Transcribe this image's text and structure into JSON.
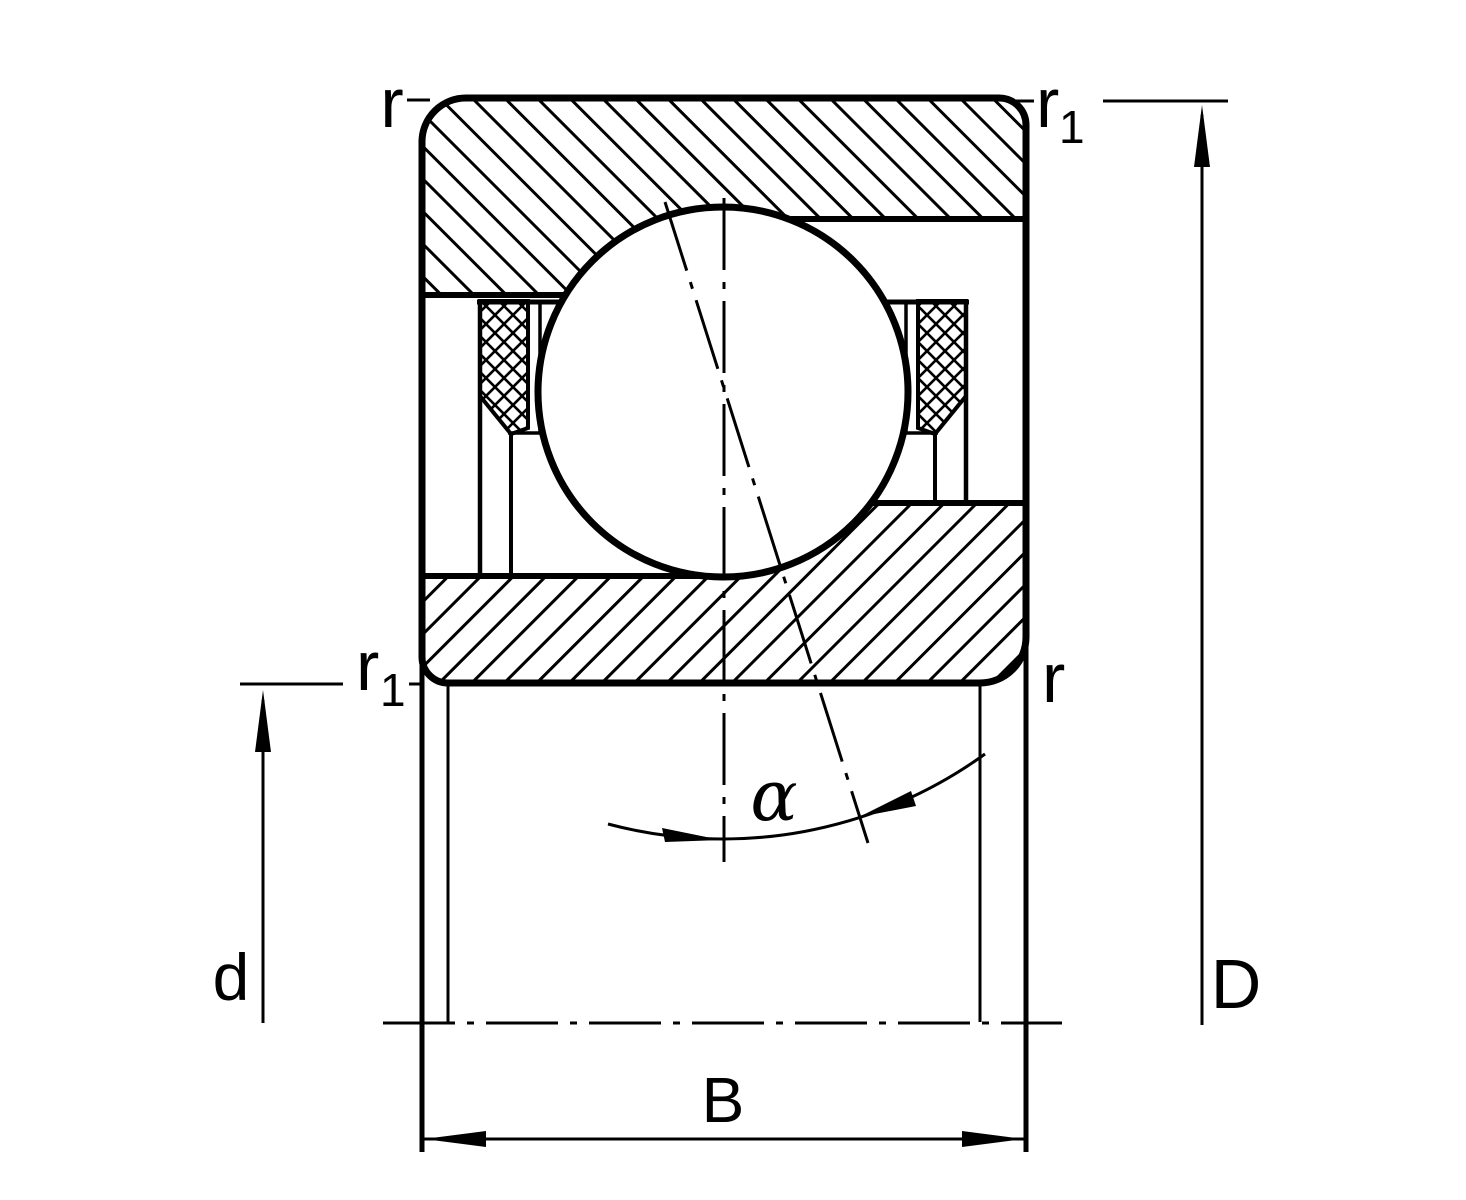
{
  "figure": {
    "labels": {
      "r": "r",
      "r1_base": "r",
      "r1_subscript": "1",
      "d": "d",
      "D": "D",
      "B": "B",
      "alpha": "α"
    },
    "colors": {
      "line": "#000000",
      "background": "#ffffff"
    }
  }
}
